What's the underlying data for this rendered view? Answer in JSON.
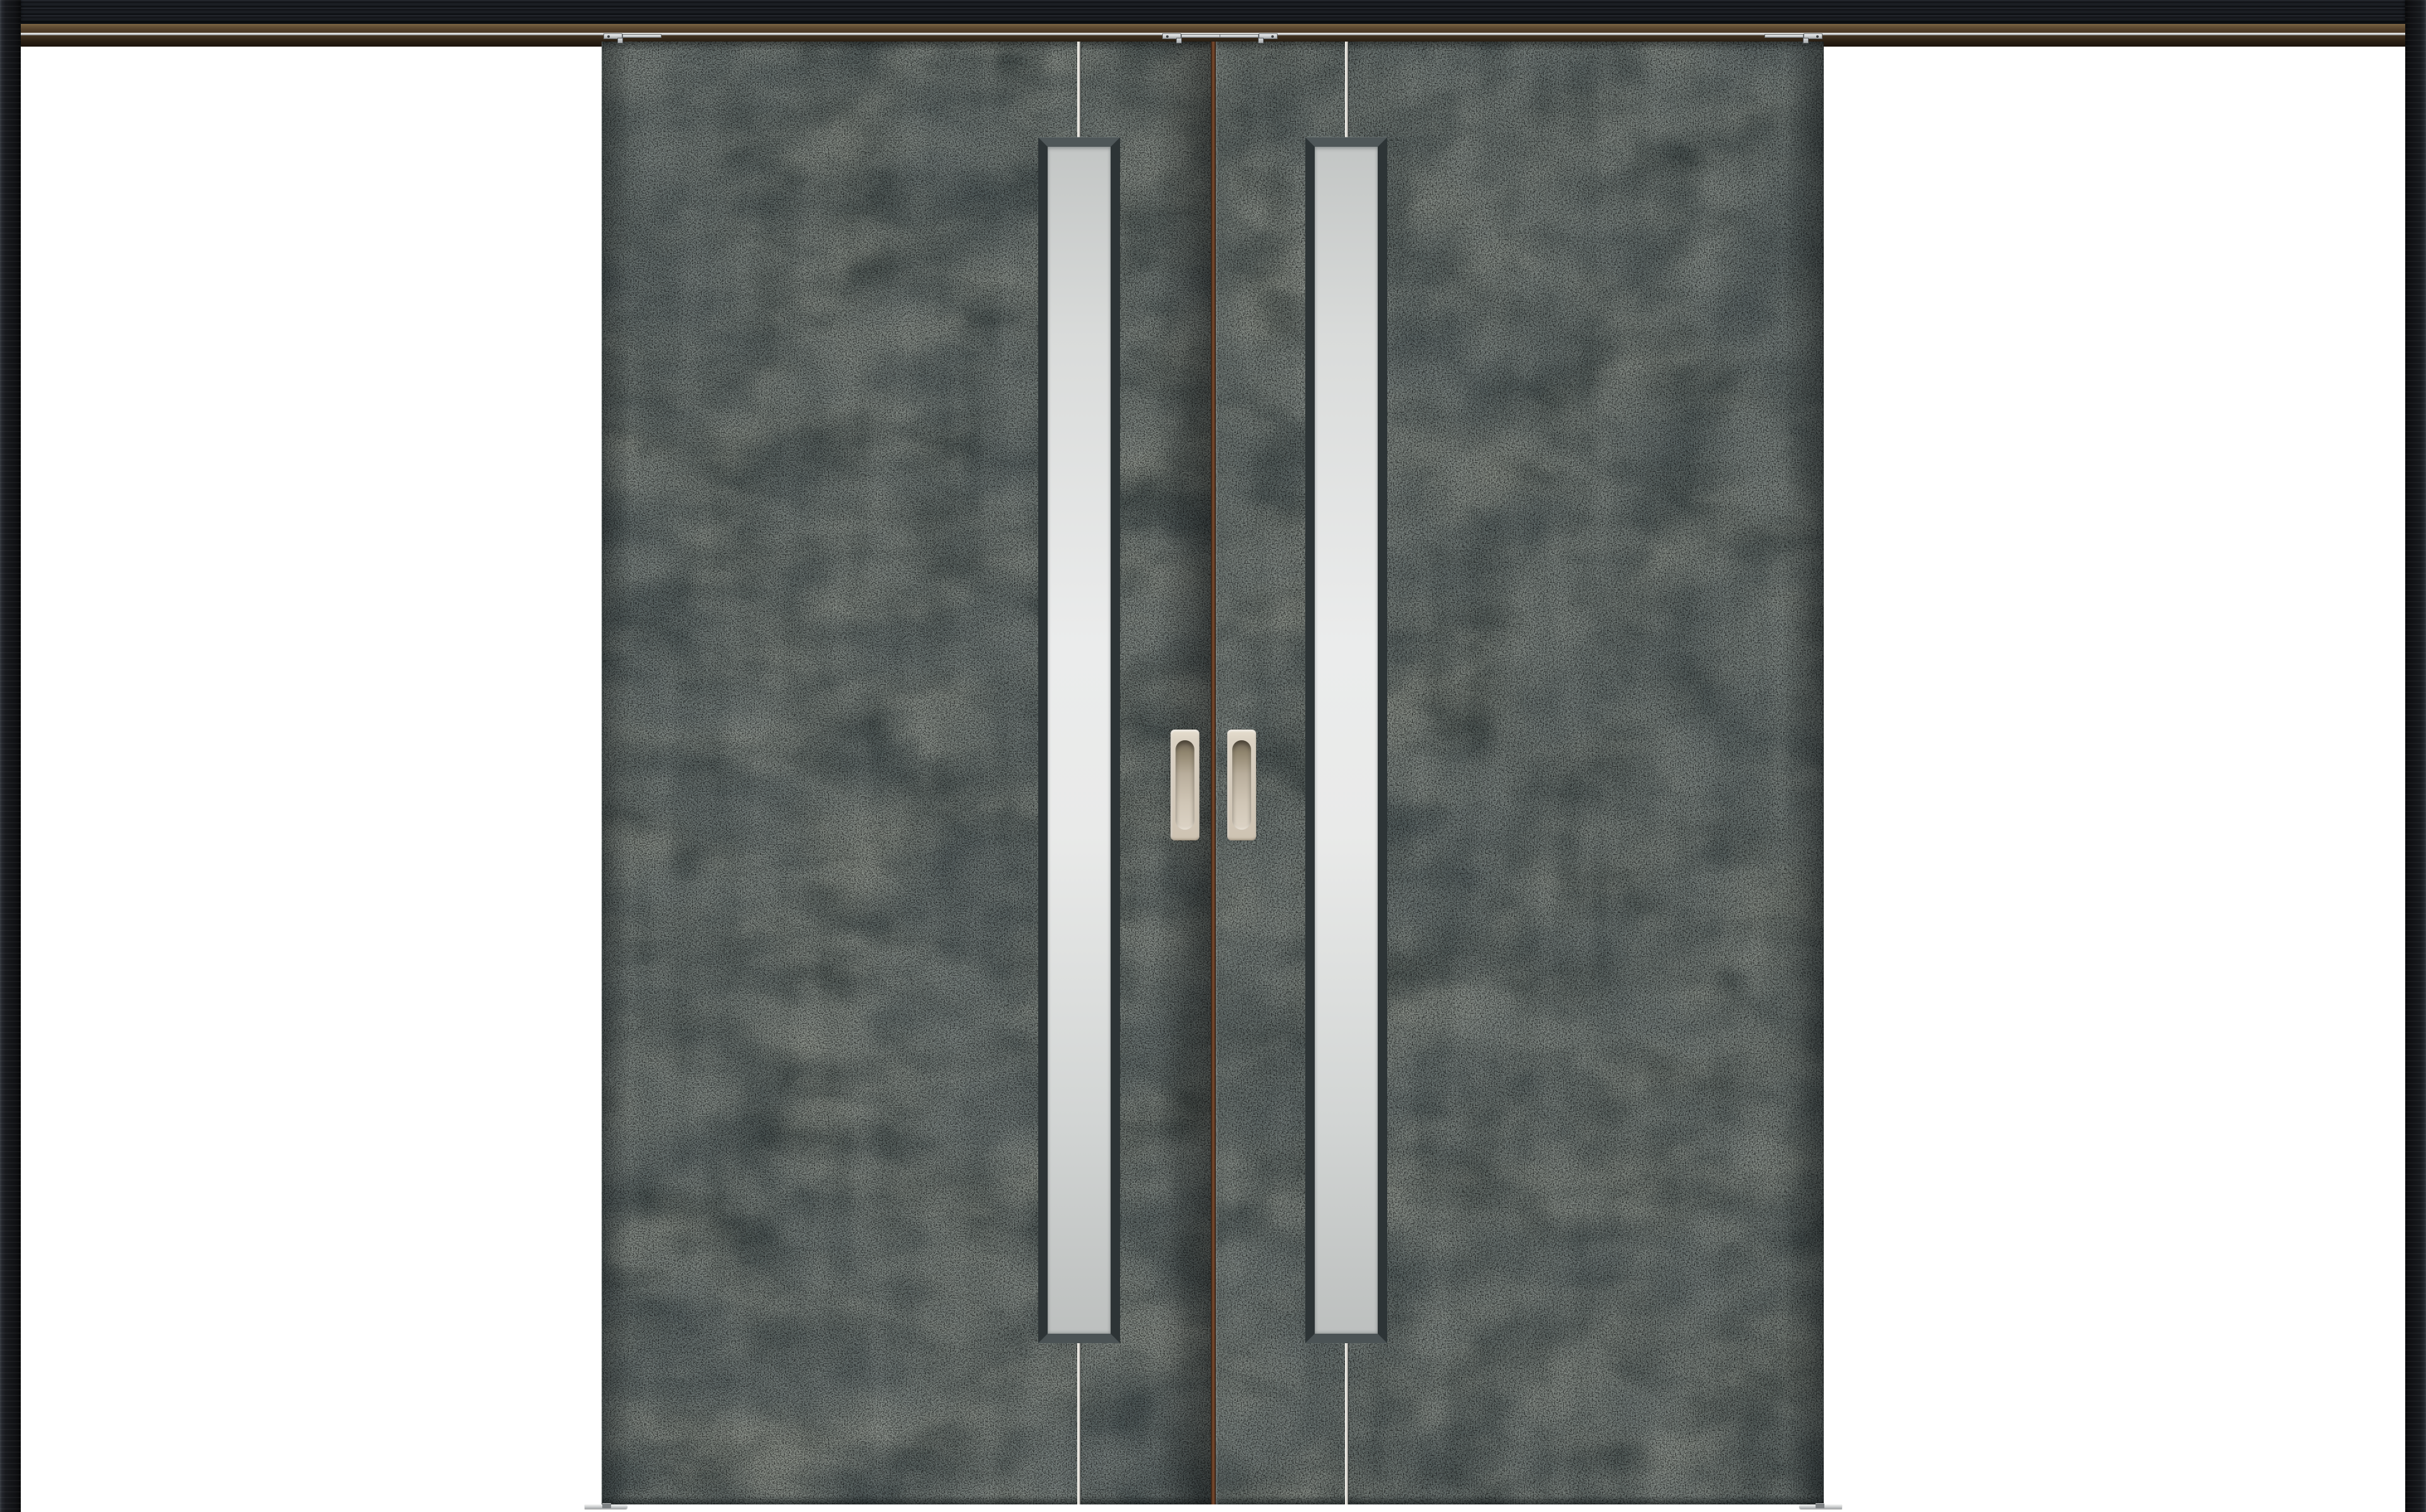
{
  "scene": {
    "type": "product-photo",
    "subject": "Double sliding interior door unit with dark patina-concrete panels and vertical frosted glass slits",
    "background_color": "#ffffff"
  },
  "frame": {
    "side_post_color": "#131519",
    "lintel_wood_color": "#1b1d22",
    "track_upper_color": "#5e4a31",
    "track_rail_color": "#cbccca",
    "track_lower_color": "#2b2014"
  },
  "doors": {
    "count": 2,
    "finish": "dark blue-grey patina concrete",
    "panel_color": "#47504e",
    "meeting_gap_color": "#7c4c2e",
    "accent_line_color": "#f1efe9"
  },
  "glass_panels": {
    "count": 2,
    "style": "vertical frosted slit",
    "glass_color": "#ebecec",
    "frame_color": "#313a3c"
  },
  "handles": {
    "count": 2,
    "type": "recessed pull",
    "plate_color": "#d5cbbc",
    "recess_shadow_color": "#6f6557"
  },
  "hardware": {
    "hanger_count": 4,
    "hanger_color": "#c6c9cb",
    "floor_guide_count": 2,
    "floor_guide_color": "#d5d7d8"
  }
}
